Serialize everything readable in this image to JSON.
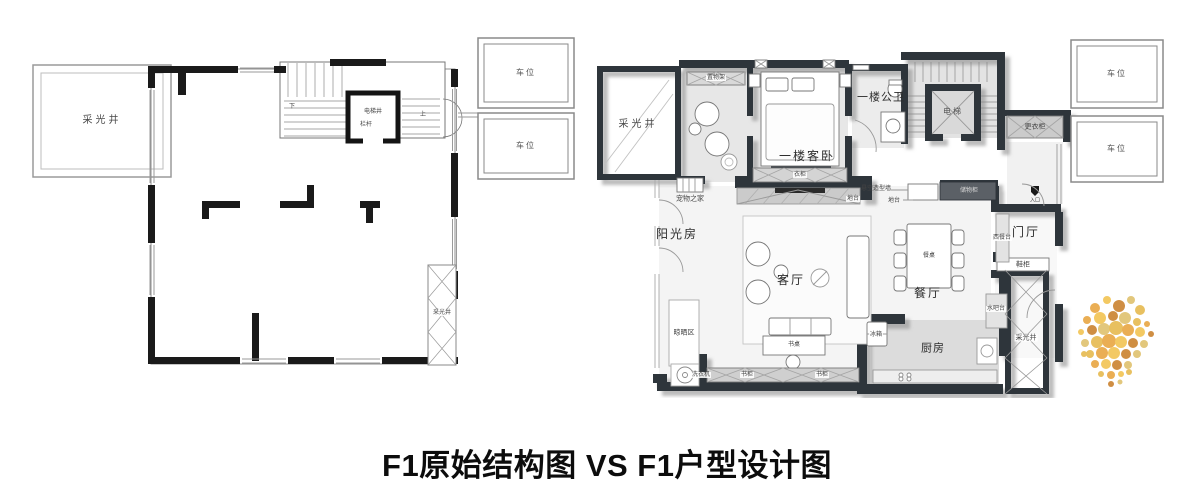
{
  "title": "F1原始结构图 VS F1户型设计图",
  "left_plan": {
    "light_well": "采光井",
    "elevator_shaft": "电梯井",
    "railing": "栏杆",
    "stair_down": "下",
    "stair_up": "上",
    "parking_top": "车位",
    "parking_bottom": "车位",
    "light_well_side": "采光井"
  },
  "right_plan": {
    "light_well": "采光井",
    "shelf": "置物架",
    "guest_bedroom": "一楼客卧",
    "wardrobe": "衣柜",
    "bathroom": "一楼公卫",
    "elevator": "电梯",
    "changing_closet": "更衣柜",
    "parking_top": "车位",
    "parking_bottom": "车位",
    "pet_home": "宠物之家",
    "sunroom": "阳光房",
    "platform_left": "地台",
    "floating_wall": "悬空造型墙",
    "platform_right": "地台",
    "storage_cabinet": "储物柜",
    "entry": "入口",
    "entry_hall": "门厅",
    "shoe_cabinet": "鞋柜",
    "western_counter": "西餐台",
    "living_room": "客厅",
    "desk": "书桌",
    "dining_table": "餐桌",
    "dining_room": "餐厅",
    "water_bar": "水吧台",
    "drying_area": "晾晒区",
    "washing_machine": "洗衣机",
    "bookcase_left": "书柜",
    "bookcase_right": "书柜",
    "fridge": "冰箱",
    "kitchen": "厨房",
    "light_well_side": "采光井"
  },
  "decor": {
    "wall_color": "#2f343a",
    "plant_colors": [
      "#e8a33d",
      "#f2c24e",
      "#c97f2a",
      "#dfc06a",
      "#e5b84b"
    ]
  }
}
